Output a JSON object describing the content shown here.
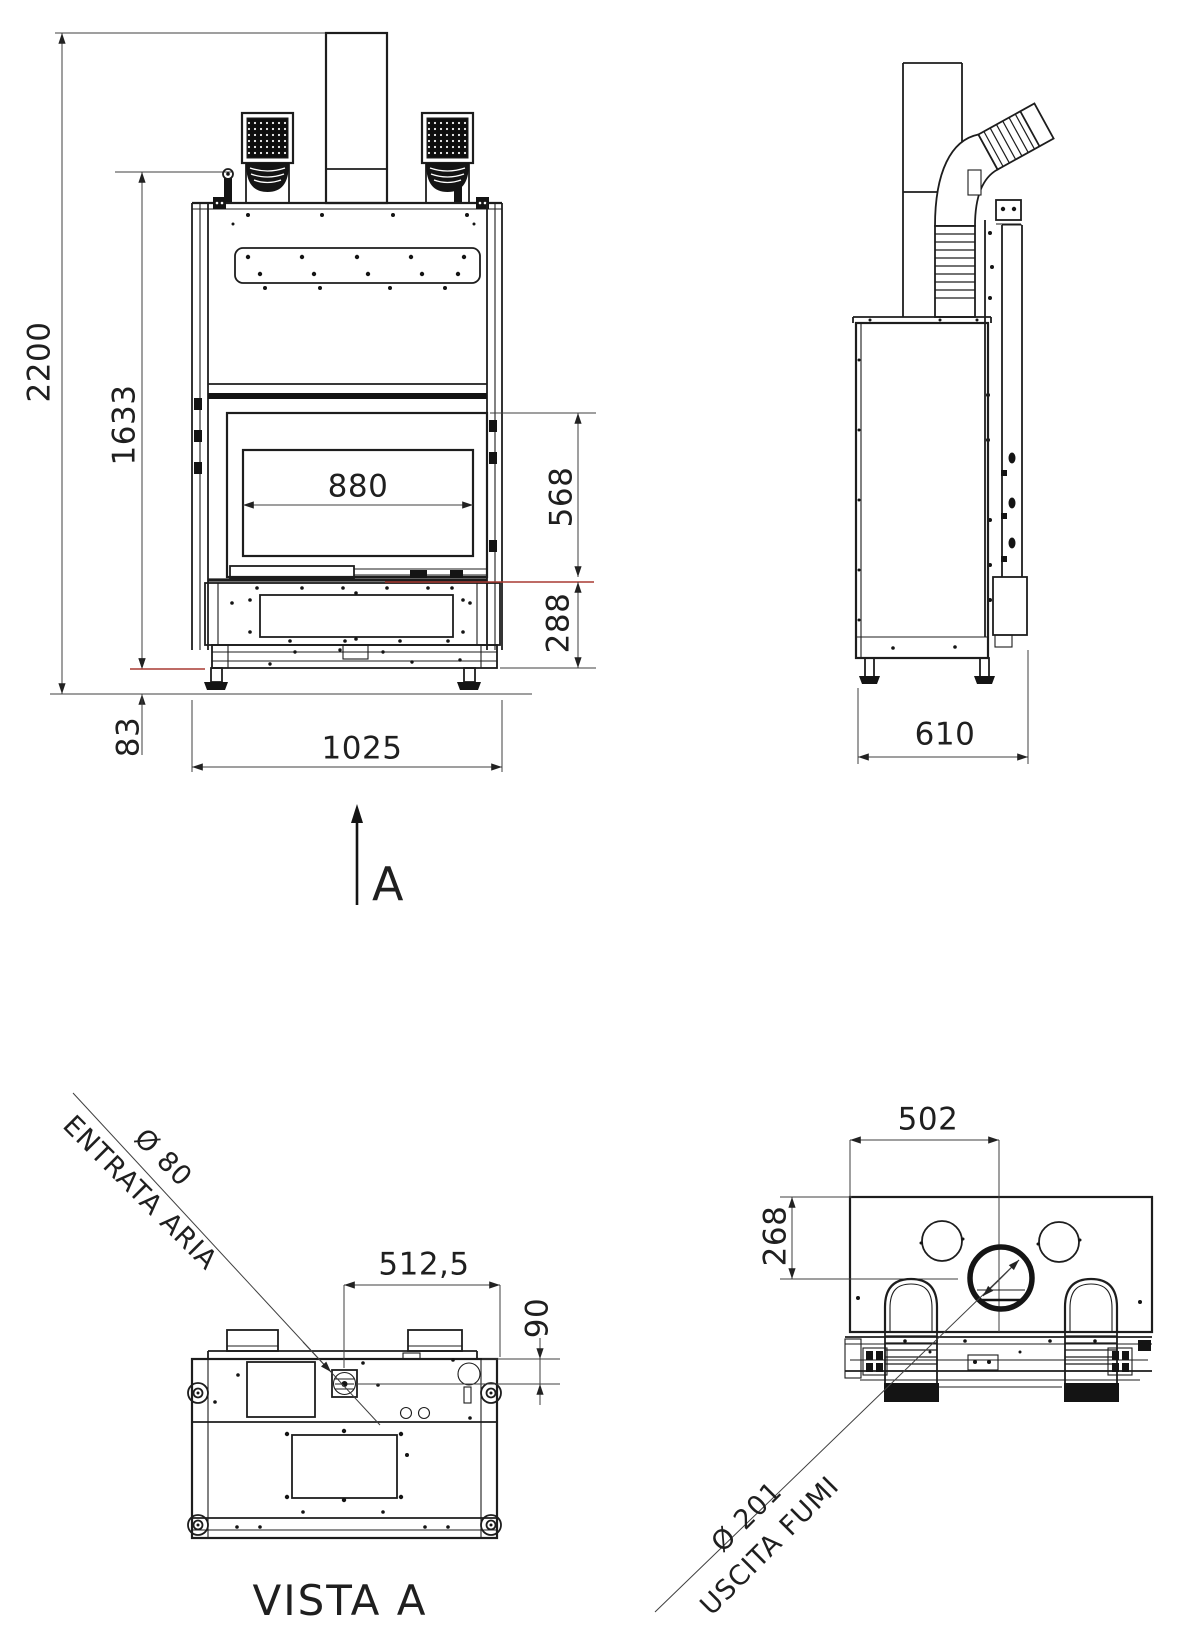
{
  "sheet": {
    "background": "#ffffff",
    "line_color": "#1d1d1d",
    "dim_line_color": "#3f3f3f",
    "accent_red": "#a83a32"
  },
  "front_view": {
    "dims": {
      "total_height": "2200",
      "upper_height": "1633",
      "glass_width": "880",
      "glass_height": "568",
      "base_height": "288",
      "feet_height": "83",
      "total_width": "1025"
    },
    "view_arrow_label": "A"
  },
  "side_view": {
    "dims": {
      "depth": "610"
    }
  },
  "bottom_view": {
    "title": "VISTA A",
    "dims": {
      "air_inlet_offset_x": "512,5",
      "air_inlet_offset_y": "90"
    },
    "callouts": {
      "air_inlet_diameter": "Ø 80",
      "air_inlet_label": "ENTRATA ARIA"
    }
  },
  "rear_view": {
    "dims": {
      "flue_offset_x": "502",
      "flue_offset_y": "268"
    },
    "callouts": {
      "flue_diameter": "Ø 201",
      "flue_label": "USCITA FUMI"
    }
  }
}
